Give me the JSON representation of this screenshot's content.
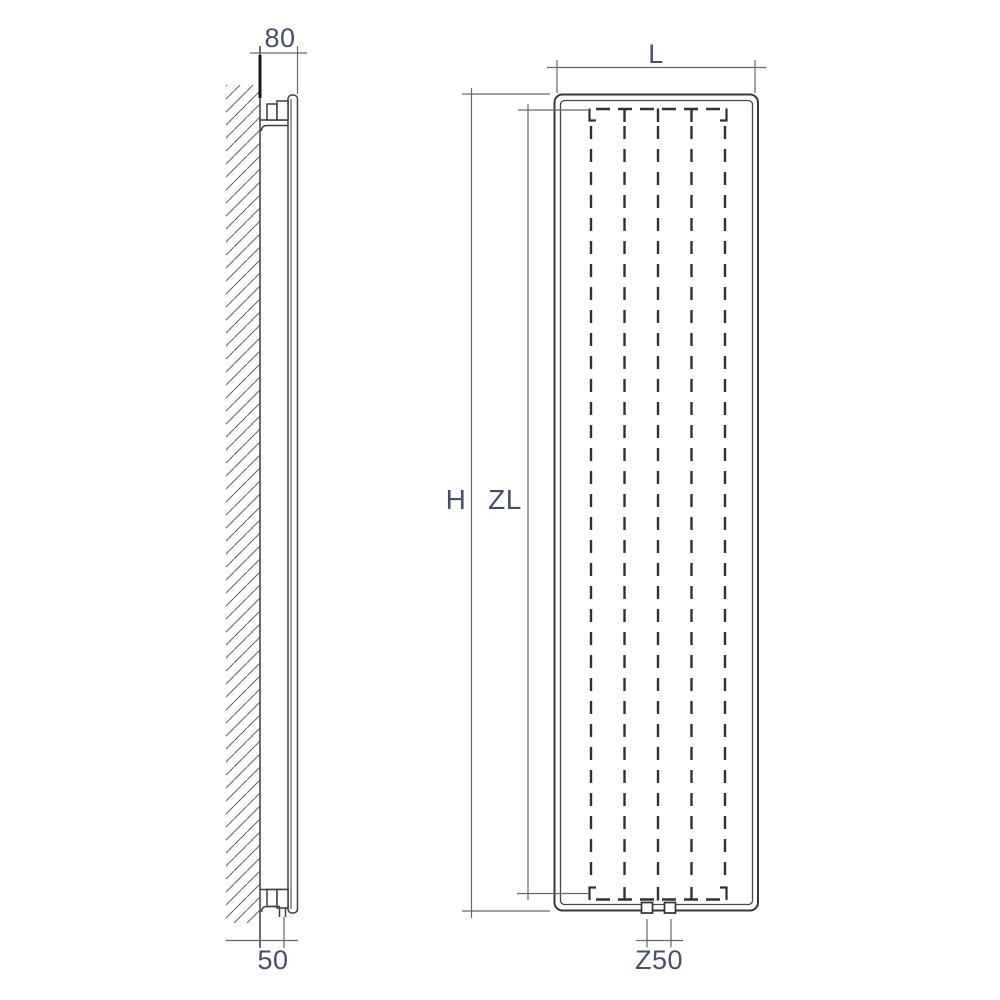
{
  "diagram": {
    "type": "technical drawing",
    "subject": "Vertical panel radiator - wall mounting side view and front view with dimension lines",
    "views": {
      "side": {
        "name": "side view (wall mounted)",
        "labels": {
          "top_clearance": "80",
          "bottom_clearance": "50"
        }
      },
      "front": {
        "name": "front view",
        "labels": {
          "width": "L",
          "height": "H",
          "inner_height": "ZL",
          "connection_spacing": "Z50"
        }
      }
    }
  },
  "colors": {
    "background": "#ffffff",
    "line": "#3b3e42",
    "dashed_line": "#2e3135",
    "dimension_line": "#63686d",
    "label_text": "#47506a"
  }
}
